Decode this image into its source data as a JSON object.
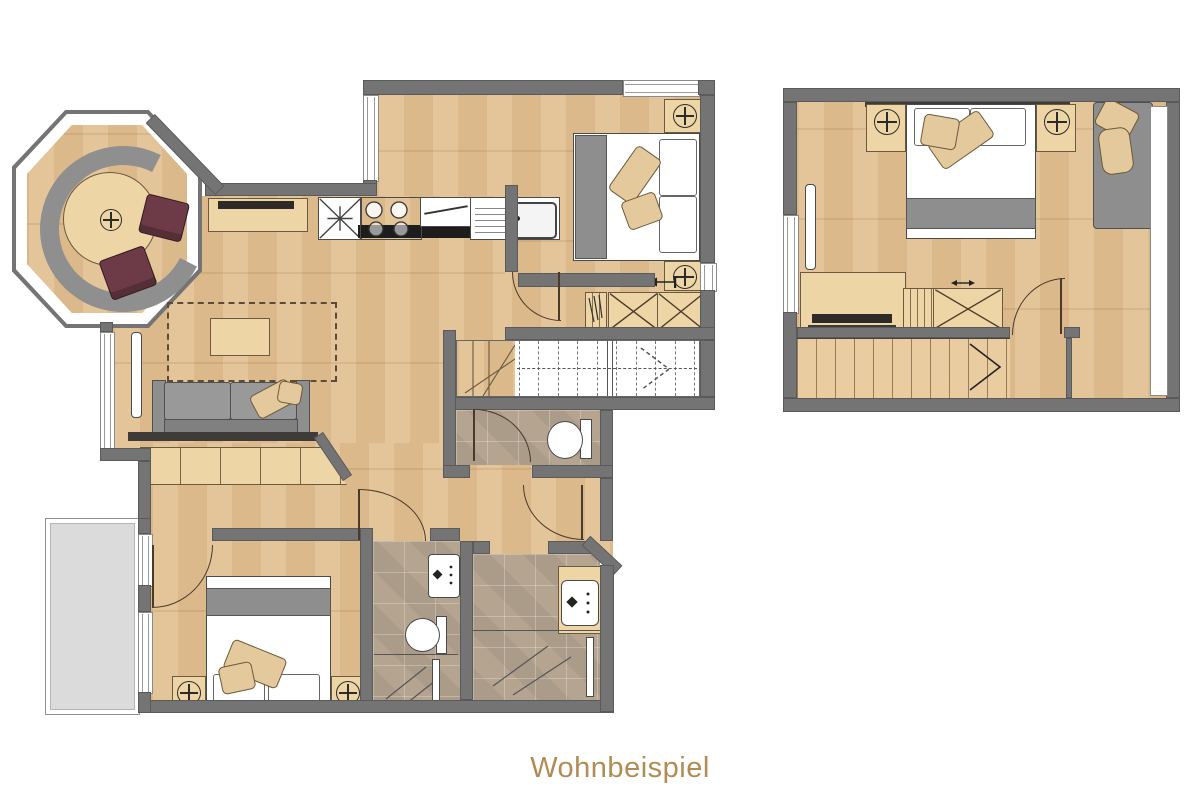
{
  "caption": {
    "text": "Wohnbeispiel"
  },
  "palette": {
    "wall": "#747474",
    "wood": "#E2C091",
    "wood_furn": "#EDD5A6",
    "tile": "#B4A490",
    "balcony": "#DBDBDB",
    "gray_furn": "#8E8E8E",
    "chair": "#6D3B47",
    "cushion": "#E4C99C",
    "line": "#4A3A2A",
    "tv": "#2E2A28",
    "caption_color": "#B18C54",
    "bg": "#FFFFFF"
  }
}
